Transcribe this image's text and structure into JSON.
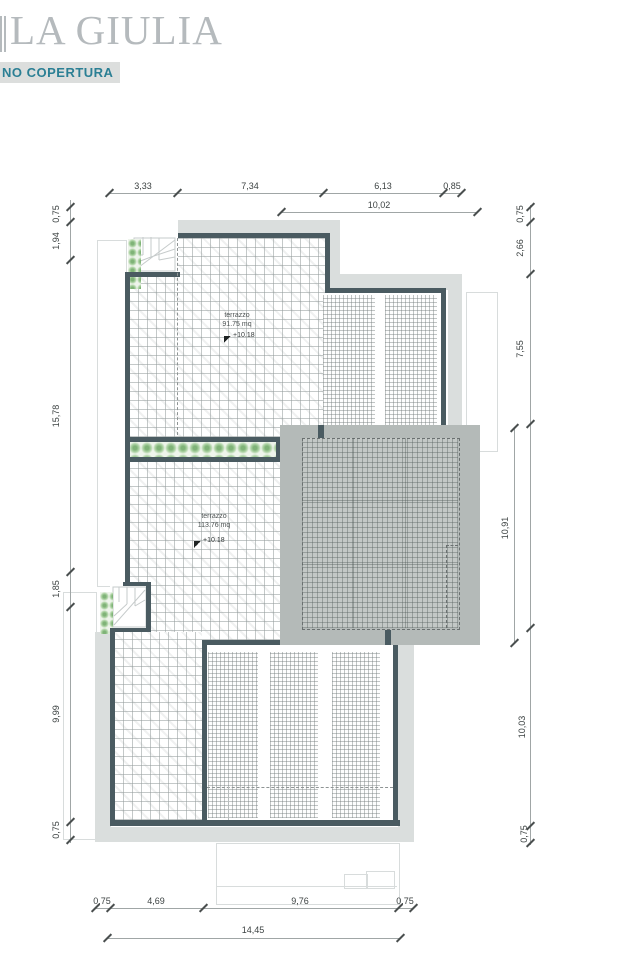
{
  "header": {
    "title": "LA GIULIA",
    "subtitle": "NO COPERTURA"
  },
  "labels": {
    "terrace_upper": {
      "name": "terrazzo",
      "area": "91.75 mq",
      "level": "+10.18"
    },
    "terrace_lower": {
      "name": "terrazzo",
      "area": "113.76 mq",
      "level": "+10.18"
    }
  },
  "dimensions": {
    "top_row1": [
      "3,33",
      "7,34",
      "6,13",
      "0,85"
    ],
    "top_row2": [
      "10,02"
    ],
    "left": [
      "0,75",
      "1,94",
      "15,78",
      "1,85",
      "9,99",
      "0,75"
    ],
    "right_outer": [
      "0,75",
      "2,66",
      "7,55",
      "10,03",
      "0,75"
    ],
    "right_inner": [
      "10,91"
    ],
    "bottom_row1": [
      "0,75",
      "4,69",
      "9,76",
      "0,75"
    ],
    "bottom_row2": [
      "14,45"
    ]
  },
  "colors": {
    "wall": "#4a5b61",
    "roof_slab_band": "#dadedd",
    "canopy_gray": "#b4bab8",
    "plant_green": "#7fb377",
    "accent_teal": "#2b7f94",
    "title_gray": "#b5babd"
  }
}
